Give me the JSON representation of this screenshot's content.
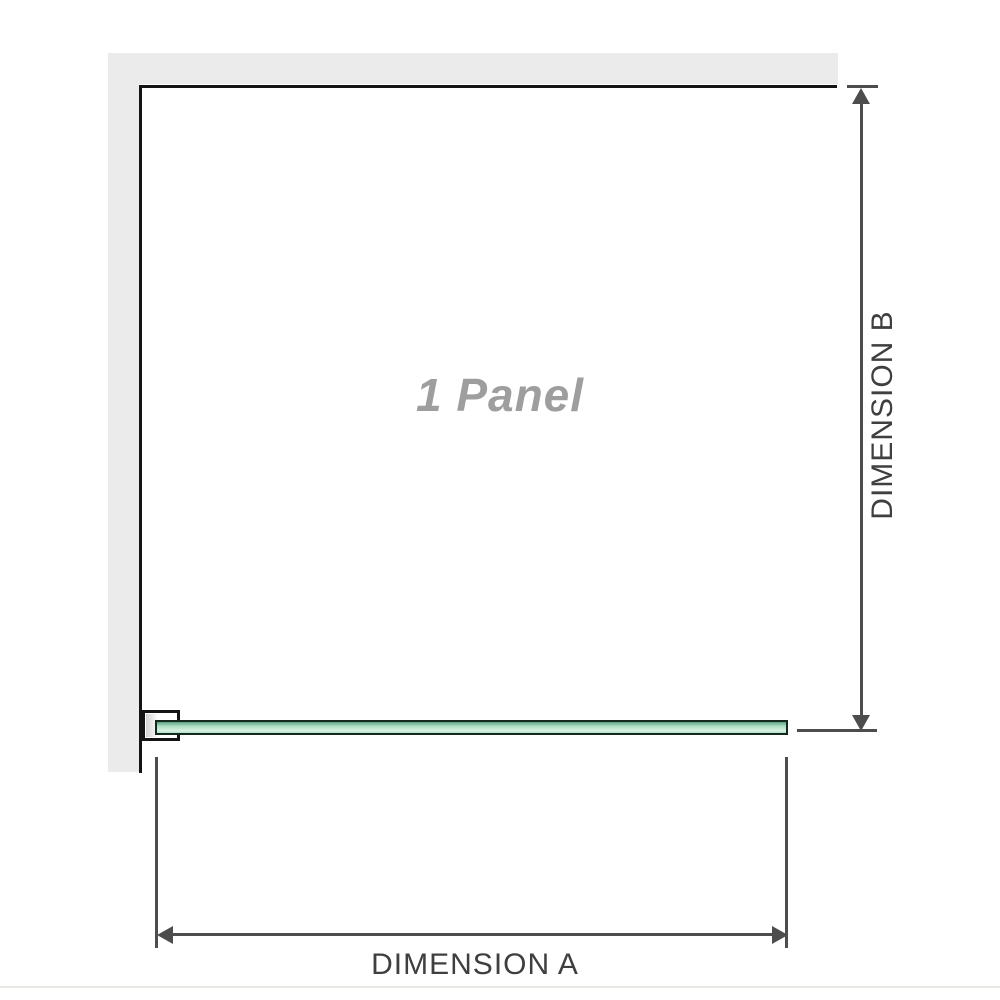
{
  "diagram": {
    "panel_label": "1 Panel",
    "dimension_a_label": "DIMENSION A",
    "dimension_b_label": "DIMENSION B"
  },
  "colors": {
    "wall": "#ebebeb",
    "outline": "#141414",
    "dimension": "#4d4d4d",
    "dim_text": "#3f3f3f",
    "panel_label": "#9e9e9e",
    "glass_dark": "#5f9f82",
    "glass_mid": "#abdfc5",
    "glass_light": "#d9f1e3",
    "glass_border": "#14281e",
    "baseline": "#e8e8e2"
  }
}
